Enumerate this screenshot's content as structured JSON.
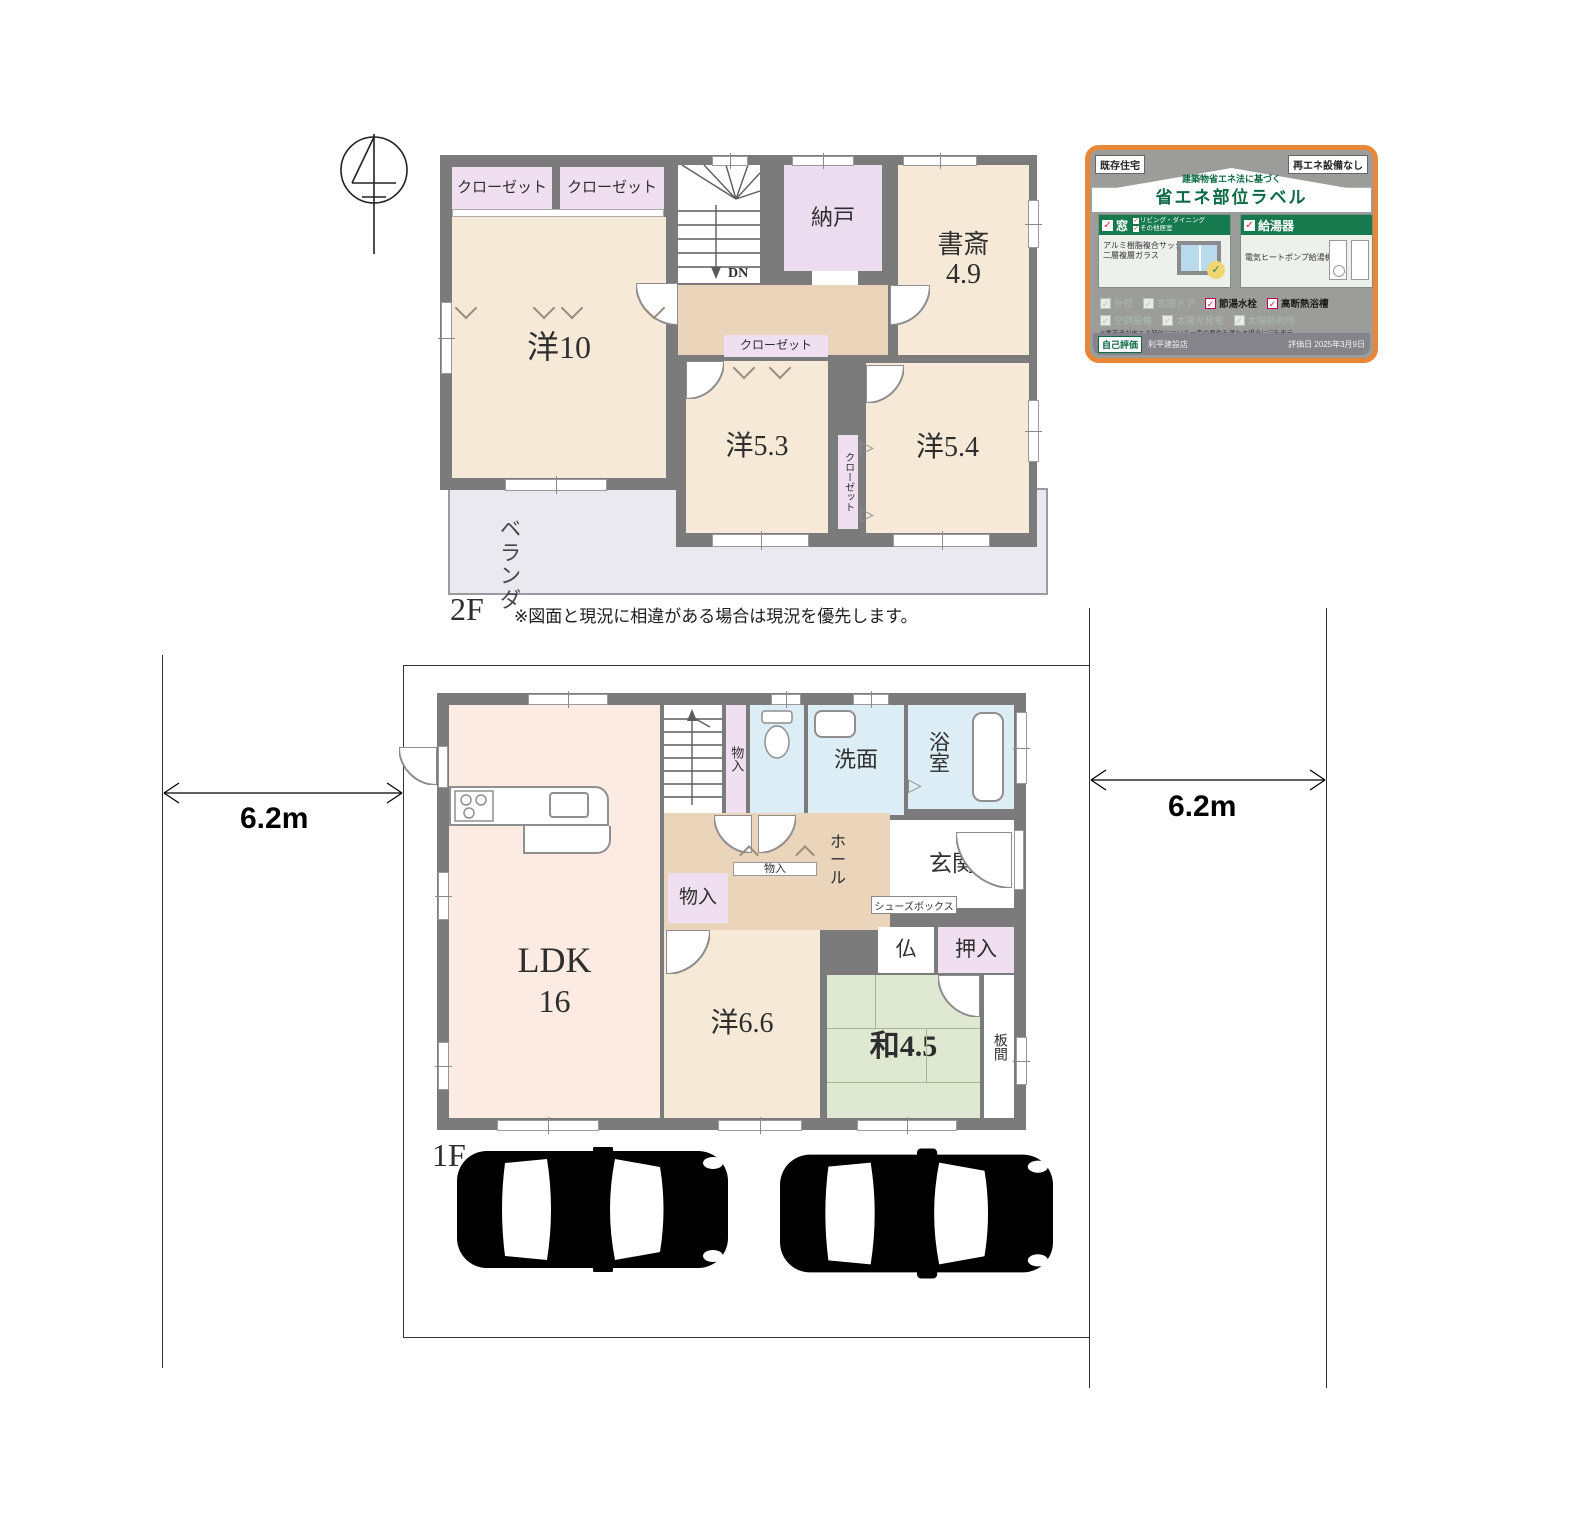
{
  "plan": {
    "floor2_label": "2F",
    "floor1_label": "1F",
    "disclaimer": "※図面と現況に相違がある場合は現況を優先します。",
    "dim_left": "6.2m",
    "dim_right": "6.2m"
  },
  "floor2": {
    "closet_a": "クローゼット",
    "closet_b": "クローゼット",
    "nando": "納戸",
    "shosai": "書斎",
    "shosai_size": "4.9",
    "yo10": "洋10",
    "dn": "DN",
    "closet_c": "クローゼット",
    "yo53": "洋5.3",
    "closet_d": "クローゼット",
    "yo54": "洋5.4",
    "veranda": "ベランダ"
  },
  "floor1": {
    "ldk": "LDK",
    "ldk_size": "16",
    "up": "UP",
    "monoiri_stair": "物入",
    "senmen": "洗面",
    "yokushitsu": "浴室",
    "hall": "ホール",
    "genkan": "玄関",
    "shoes_box": "シューズボックス",
    "monoiri_wall": "物入",
    "monoiri_left": "物入",
    "yo66": "洋6.6",
    "butsu": "仏",
    "oshiire": "押入",
    "wa45": "和4.5",
    "itama": "板間"
  },
  "energy": {
    "badge_left": "既存住宅",
    "badge_right": "再エネ設備なし",
    "subtitle": "建築物省エネ法に基づく",
    "title": "省エネ部位ラベル",
    "win_title": "窓",
    "win_sub1": "リビング・ダイニング",
    "win_sub2": "その他居室",
    "win_desc1": "アルミ樹脂複合サッシ",
    "win_desc2": "二層複層ガラス",
    "heat_title": "給湯器",
    "heat_desc": "電気ヒートポンプ給湯機",
    "chk_gaiheki": "外壁",
    "chk_genkan_door": "玄関ドア",
    "chk_setsuyu": "節湯水栓",
    "chk_danetsu": "高断熱浴槽",
    "chk_kucho": "空調設備",
    "chk_taiyoko": "太陽光発電",
    "chk_taiyonetsu": "太陽熱利用",
    "note1": "※事業者が省エネ部位について一定の要件を満たす場合に☑を表示",
    "note2": "※各部位の仕様・性能等の詳細は（1月に更新）（省略している場合あり）",
    "self_eval": "自己評価",
    "company": "利平建設店",
    "eval_date": "評価日 2025年3月9日"
  },
  "colors": {
    "wall": "#7b7b7b",
    "room_cream": "#f6e9d8",
    "ldk_pink": "#fbebe2",
    "closet_pink": "#f0dff0",
    "wet_blue": "#dcedf6",
    "tatami_green": "#dfe9d2",
    "hall_tan": "#ead4ba",
    "veranda_gray": "#e9e9ef",
    "card_orange": "#e8873a",
    "card_green": "#177a4e"
  }
}
